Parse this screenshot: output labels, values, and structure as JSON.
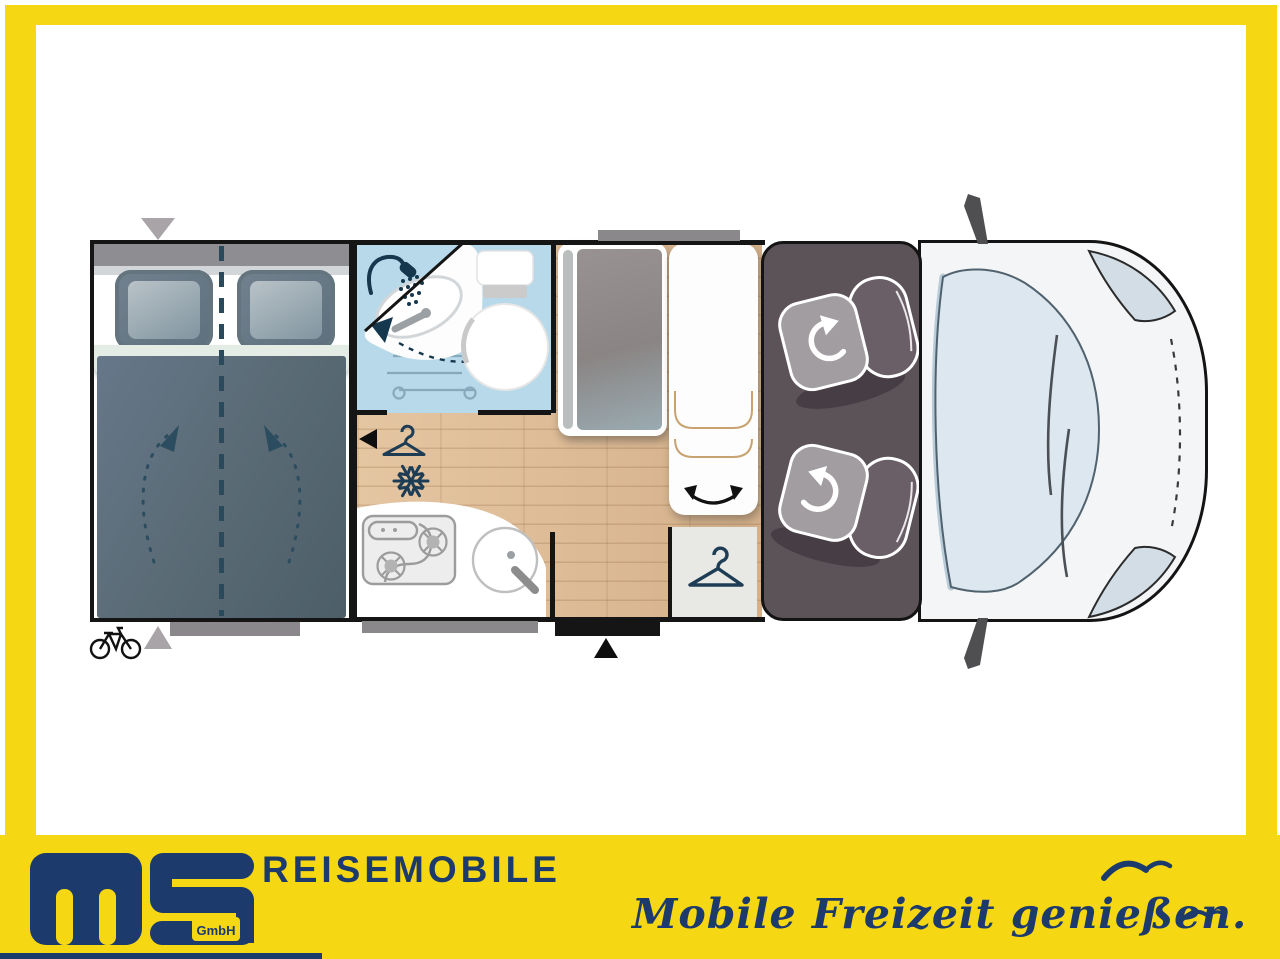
{
  "branding": {
    "company_line": "REISEMOBILE",
    "company_suffix": "GmbH",
    "slogan": "Mobile Freizeit genießen.",
    "colors": {
      "brand_yellow": "#F6D714",
      "brand_navy": "#1C3A6B"
    }
  },
  "floorplan": {
    "view": "top-down motorhome layout",
    "rooms": [
      "rear-double-bed",
      "washroom-with-shower-sink-toilet",
      "kitchen-with-hob-and-sink",
      "dinette-table",
      "bench-seat",
      "wardrobe",
      "cab-with-two-swivel-seats",
      "vehicle-front"
    ],
    "icons": [
      "shower-icon",
      "wardrobe-hanger-icon",
      "fridge-snowflake-icon",
      "sink-swivel-arrow",
      "bed-fold-arrows",
      "seat-swivel-arrow",
      "bench-rotate-arrow",
      "bicycle-icon",
      "door-marker-triangle",
      "entry-step-marker",
      "seagull-icon"
    ],
    "colors": {
      "wall": "#151515",
      "wet_room": "#B7D9E9",
      "floor_wood": "#DDBB95",
      "bed_textile": "#5E6F7A",
      "cab_floor": "#5C5359",
      "windshield": "#DDE7EF",
      "marker_gray": "#A8A4A8"
    }
  }
}
